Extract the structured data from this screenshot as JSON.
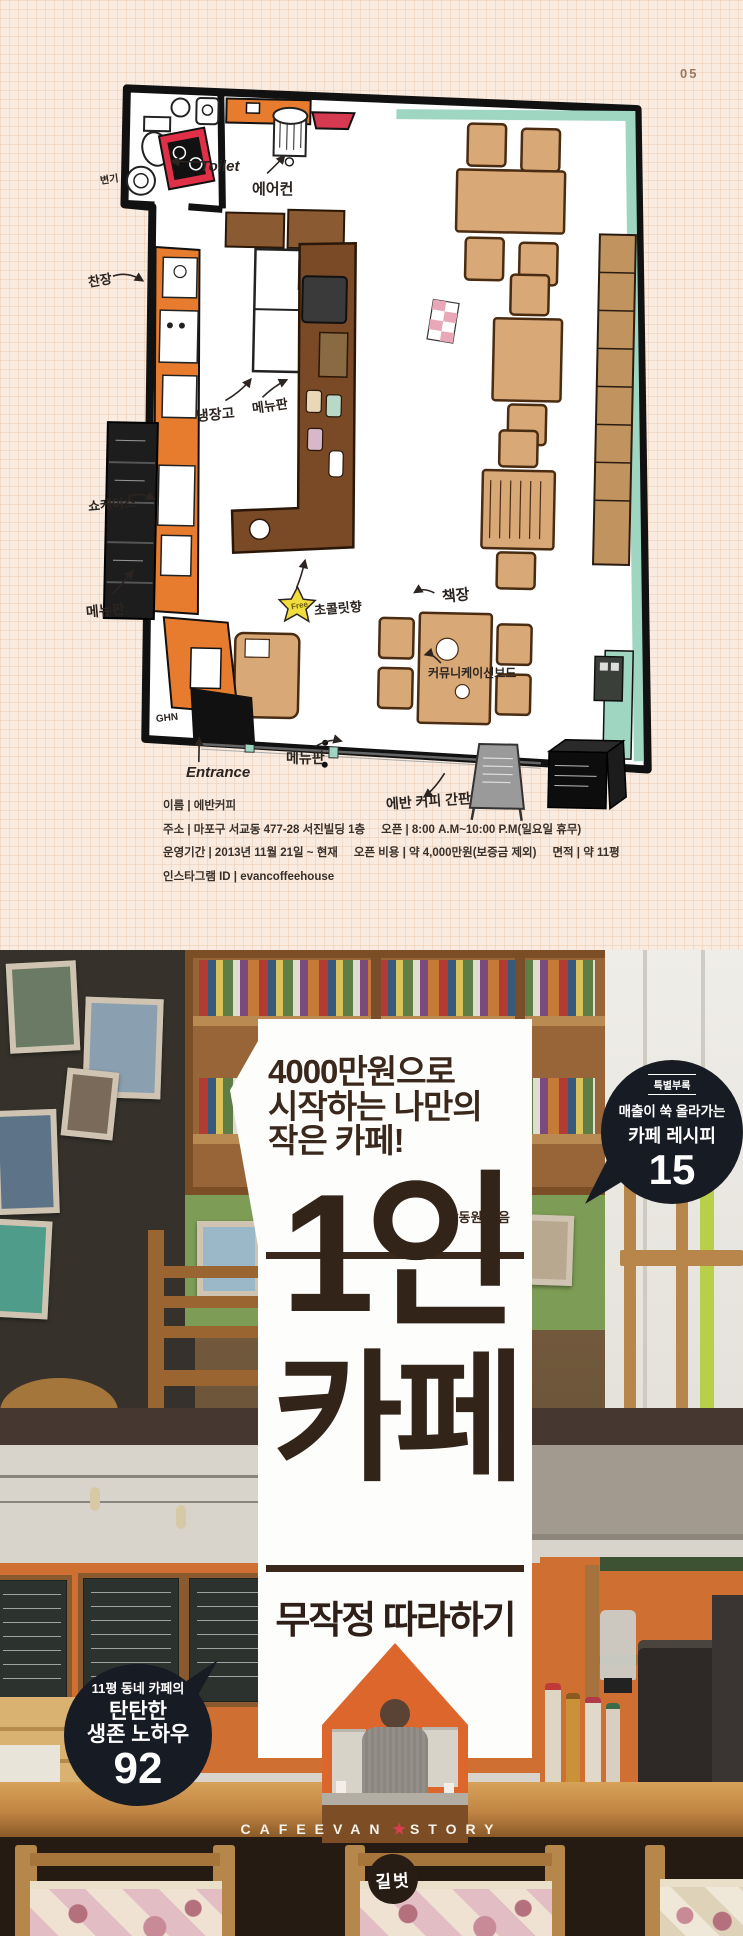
{
  "page": {
    "number": "05"
  },
  "colors": {
    "cream_bg": "#f9ebdf",
    "accent_orange": "#e87c2e",
    "navy": "#171b24",
    "title_brown": "#3a281c",
    "teal": "#9fd6c2",
    "red": "#d53a50",
    "star_yellow": "#f2dd3e",
    "wood": "#c08443",
    "footer_star_red": "#d6404e"
  },
  "plan": {
    "labels": {
      "toilet_item": "변기",
      "toilet": "Toilet",
      "aircon": "에어컨",
      "cupboard": "찬장",
      "fridge": "냉장고",
      "menu_top": "메뉴판",
      "showcase": "쇼케이스",
      "menu_left": "메뉴판",
      "free": "Free",
      "chocolate": "초콜릿향",
      "bookshelf": "책장",
      "comm_board": "커뮤니케이션보드",
      "menu_bottom": "메뉴판",
      "entrance": "Entrance",
      "signboard": "에반 커피 간판",
      "signature": "GHN"
    },
    "info": {
      "name": "이름 | 에반커피",
      "address": "주소 | 마포구 서교동 477-28 서진빌딩 1층",
      "open": "오픈 | 8:00 A.M~10:00 P.M(일요일 휴무)",
      "period": "운영기간 | 2013년 11월 21일 ~ 현재",
      "cost": "오픈 비용 | 약 4,000만원(보증금 제외)",
      "area": "면적 | 약 11평",
      "instagram": "인스타그램 ID | evancoffeehouse"
    }
  },
  "cover": {
    "tagline1": "4000만원으로",
    "tagline2": "시작하는 나만의",
    "tagline3": "작은 카페!",
    "author": "강동원 지음",
    "title_line1": "1인",
    "title_line2": "카페",
    "subtitle": "무작정 따라하기",
    "bubble": {
      "tag": "특별부록",
      "line1": "매출이 쑥 올라가는",
      "line2": "카페 레시피",
      "number": "15"
    },
    "badge": {
      "line1": "11평 동네 카페의",
      "line2": "탄탄한",
      "line3": "생존 노하우",
      "number": "92"
    },
    "footer_left": "CAFEEVAN",
    "footer_right": "STORY",
    "publisher": "길벗"
  }
}
